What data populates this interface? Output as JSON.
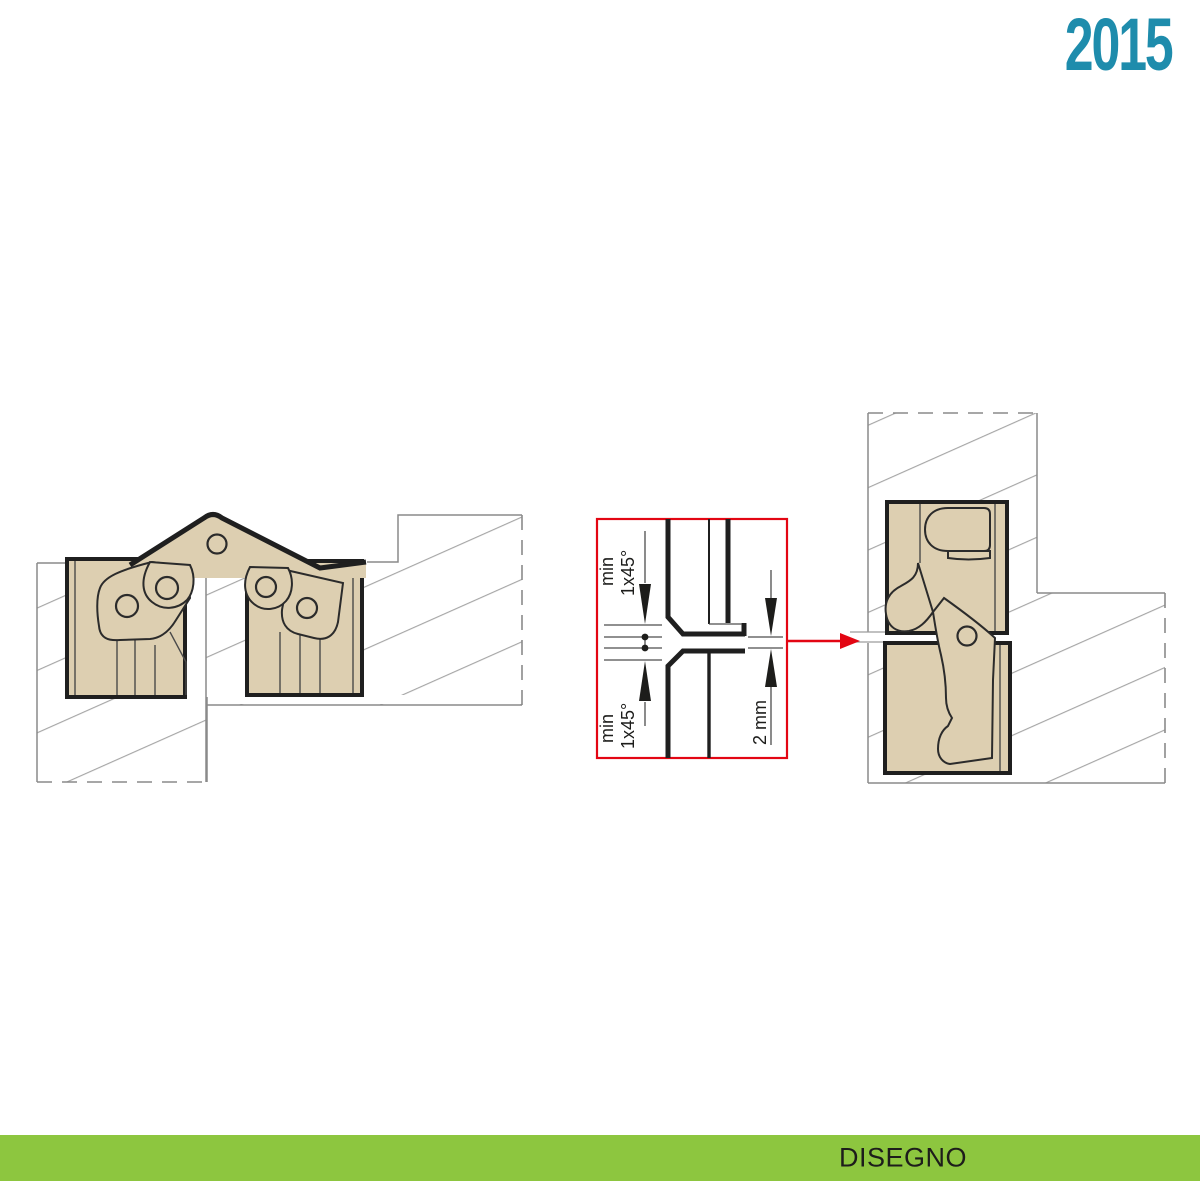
{
  "page": {
    "year": "2015",
    "footer_label": "DISEGNO"
  },
  "colors": {
    "accent_green": "#8dc63f",
    "accent_blue": "#1e8cac",
    "accent_red": "#e30613",
    "wood_fill": "#ddcfb1",
    "line_dark": "#1f1f1f",
    "line_gray": "#8a8a8a"
  },
  "detail_labels": {
    "top_chamfer": {
      "line1": "min",
      "line2": "1x45°"
    },
    "bottom_chamfer": {
      "line1": "min",
      "line2": "1x45°"
    },
    "gap": "2 mm"
  }
}
